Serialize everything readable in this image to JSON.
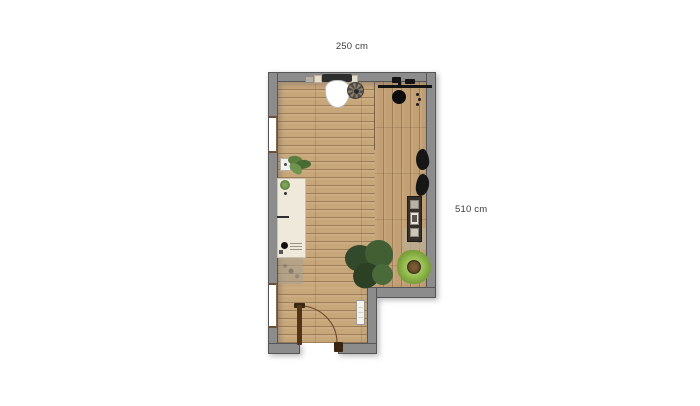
{
  "floor_plan": {
    "title": "room-floor-plan",
    "dimensions": {
      "width_label": "250 cm",
      "height_label": "510 cm"
    },
    "colors": {
      "background": "#ffffff",
      "wall_fill": "#8c8c8c",
      "wall_edge": "#565656",
      "floor_wood": "#c7a67a",
      "floor_plank_line": "#7a5e3c",
      "counter_fill": "#efe9dc",
      "toilet_white": "#ffffff",
      "plant_dark_green": "#33492b",
      "plant_light_green": "#7ba33a",
      "door_wood": "#4f3419",
      "black_fixture": "#141414",
      "window_frame": "#8a6a4a"
    },
    "items": [
      {
        "name": "wall-switch"
      },
      {
        "name": "wall-hung-toilet"
      },
      {
        "name": "floor-fan"
      },
      {
        "name": "coat-rack-with-hat"
      },
      {
        "name": "wall-hooks"
      },
      {
        "name": "window-upper-left"
      },
      {
        "name": "potted-plant-small"
      },
      {
        "name": "counter-desk"
      },
      {
        "name": "doormat-left"
      },
      {
        "name": "window-lower-left"
      },
      {
        "name": "hanging-bags"
      },
      {
        "name": "picture-shelf"
      },
      {
        "name": "textured-mat-right"
      },
      {
        "name": "plant-large-dark"
      },
      {
        "name": "plant-large-light"
      },
      {
        "name": "radiator"
      },
      {
        "name": "entry-door-with-swing"
      }
    ]
  }
}
